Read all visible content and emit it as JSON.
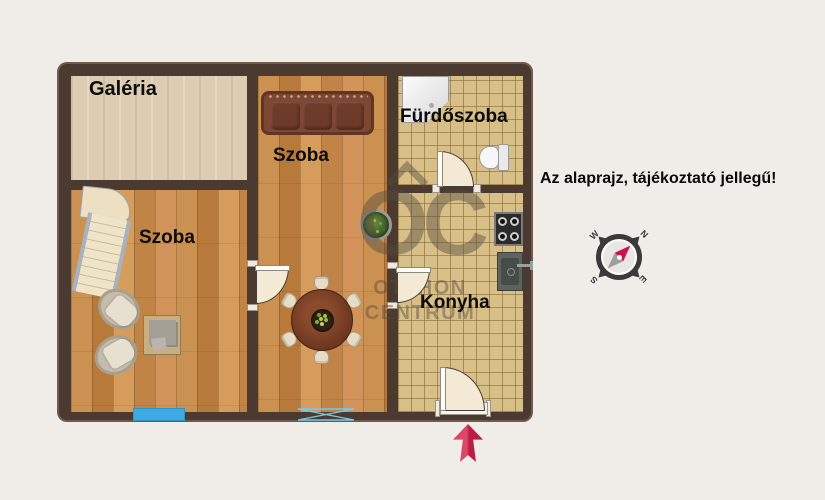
{
  "plan": {
    "disclaimer": "Az alaprajz, tájékoztató jellegű!",
    "rooms": {
      "galeria": "Galéria",
      "szoba_left": "Szoba",
      "szoba_center": "Szoba",
      "furdoszoba": "Fürdőszoba",
      "konyha": "Konyha"
    },
    "watermark": {
      "logo": "OC",
      "line1": "OTTHON",
      "line2": "CENTRUM"
    },
    "compass": {
      "n": "N",
      "e": "E",
      "s": "S",
      "w": "W"
    },
    "furniture_icons": [
      "stairs-icon",
      "armchair-icon",
      "side-table-icon",
      "sofa-icon",
      "plant-icon",
      "dining-table-icon",
      "chair-icon",
      "shower-icon",
      "toilet-icon",
      "stove-icon",
      "sink-icon",
      "window-icon",
      "door-icon",
      "entrance-arrow-icon",
      "compass-icon"
    ],
    "colors": {
      "wall": "#4b3a2f",
      "wood_floor": "#c68a48",
      "tile_floor": "#d8bf88",
      "galeria_floor": "#dccdb2",
      "window_blue": "#3fabe4",
      "entry_arrow_red": "#c8224b",
      "compass_needle_red": "#c8134d"
    }
  }
}
